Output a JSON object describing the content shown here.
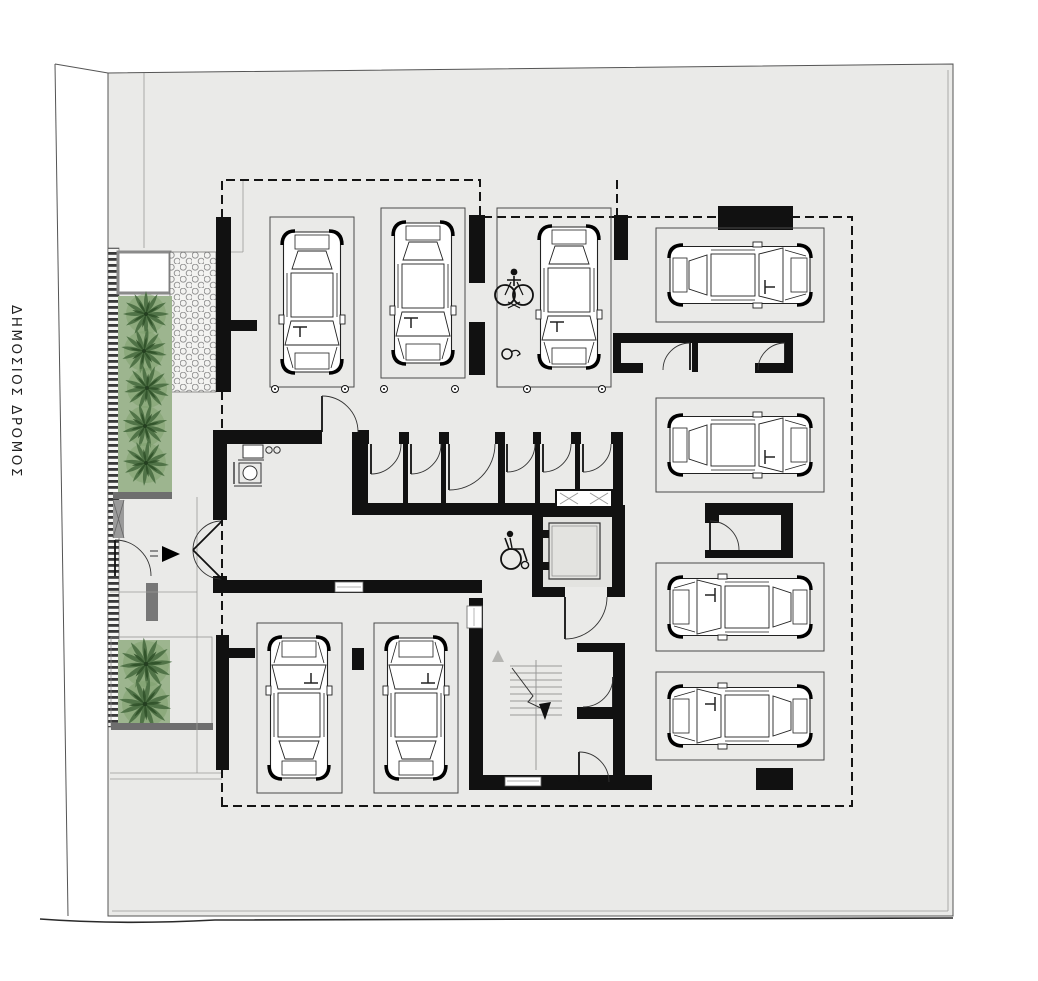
{
  "labels": {
    "road": "ΔΗΜΟΣΙΟΣ ΔΡΟΜΟΣ"
  },
  "colors": {
    "floor": "#eaeae8",
    "room": "#e3e3e0",
    "wall": "#111111",
    "greenery": "#9db58f",
    "tree_dark": "#2f5129",
    "tree_mid": "#4d7145",
    "cap": "#6e6e6e",
    "paper": "#ffffff"
  },
  "plan": {
    "type": "parking-level floor plan",
    "parking_stalls": {
      "total": 9,
      "top_row_vertical": 3,
      "bottom_row_vertical": 2,
      "right_column_horizontal": 4,
      "accessible": 1
    },
    "trees": {
      "upper_strip": 5,
      "lower_strip": 2,
      "total": 7
    },
    "storage_rooms": {
      "center_row": 6,
      "right_pair": 2,
      "right_single": 1,
      "near_stairs": 2
    },
    "cores": {
      "elevators": 1,
      "staircases": 1
    },
    "icons": [
      "wheelchair-icon",
      "car-icon",
      "tree-icon",
      "stairs-up-arrow-icon",
      "entry-arrow-icon",
      "duct-icon"
    ]
  }
}
